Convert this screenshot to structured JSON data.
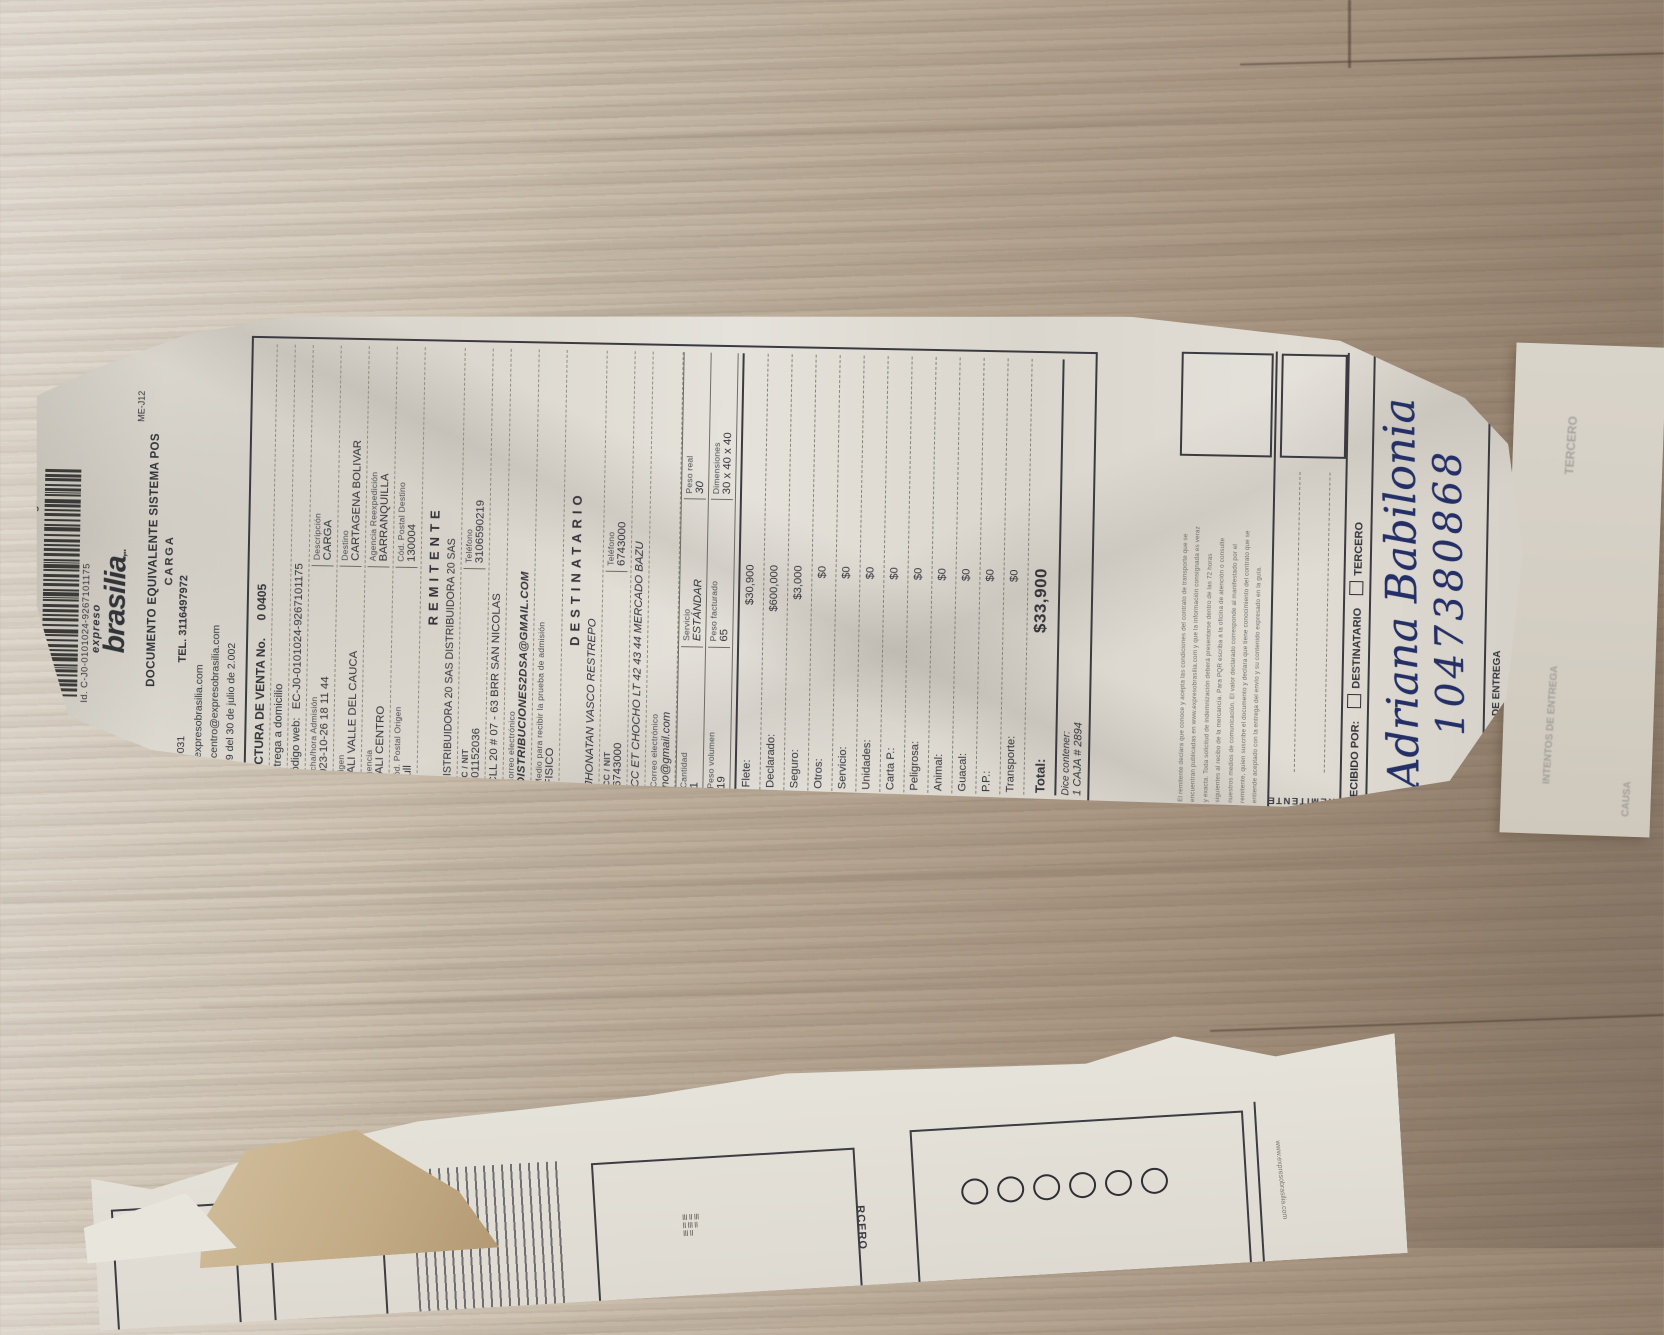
{
  "header": {
    "ce_label": "CE - Contra Entrega",
    "form_code": "ME-J12",
    "id_line": "Id. C-J0-0101024-9267101175",
    "brand_top": "expreso",
    "brand_main": "brasilia",
    "brand_suffix": ",..",
    "doc_title": "DOCUMENTO EQUIVALENTE SISTEMA POS",
    "doc_subtitle": "CARGA",
    "account_number": "90100031",
    "phone": "TEL. 3116497972",
    "web": "www.expresobrasilia.com",
    "email": "enviocentro@expresobrasilia.com",
    "resolution": "00159 del 30 de julio de 2.002"
  },
  "invoice": {
    "factura_label": "FACTURA  DE  VENTA  No.",
    "factura_value": "0  0405",
    "entrega": "Entrega a domicilio",
    "codigo_web_label": "Código web:",
    "codigo_web_value": "EC-J0-0101024-9267101175",
    "fecha_label": "Fecha/hora Admisión",
    "fecha_value": "2023-10-26 18 11 44",
    "descripcion_label": "Descripción",
    "descripcion_value": "CARGA",
    "origen_label": "Origen",
    "origen_value": "CALI VALLE DEL CAUCA",
    "destino_label": "Destino",
    "destino_value": "CARTAGENA BOLIVAR",
    "agencia_label": "Agencia",
    "agencia_value": "CALI CENTRO",
    "reexp_label": "Agencia Reexpedición",
    "reexp_value": "BARRANQUILLA",
    "cp_origen_label": "Cód. Postal Origen",
    "cp_origen_value": "null",
    "cp_destino_label": "Cód. Postal Destino",
    "cp_destino_value": "130004"
  },
  "remitente": {
    "title": "REMITENTE",
    "nombre": "DISTRIBUIDORA 20 SAS DISTRIBUIDORA 20 SAS",
    "cc_label": "CC / NIT",
    "cc_value": "901152036",
    "tel_label": "Teléfono",
    "tel_value": "3106590219",
    "direccion": "CLL 20 # 07 - 63 BRR SAN NICOLAS",
    "correo_label": "Correo electrónico",
    "correo_value": "DISTRIBUCIONES2DSA@GMAIL.COM",
    "medio_label": "Medio para recibir la prueba de admisión",
    "medio_value": "FISICO"
  },
  "destinatario": {
    "title": "DESTINATARIO",
    "nombre": "JHONATAN VASCO RESTREPO",
    "cc_label": "CC / NIT",
    "cc_value": "6743000",
    "tel_label": "Teléfono",
    "tel_value": "6743000",
    "direccion": "CC ET CHOCHO LT 42 43 44 MERCADO BAZU",
    "correo_label": "Correo electrónico",
    "correo_value": "no@gmail.com"
  },
  "shipment": {
    "cantidad_label": "Cantidad",
    "cantidad_value": "1",
    "servicio_label": "Servicio",
    "servicio_value": "ESTÁNDAR",
    "peso_real_label": "Peso real",
    "peso_real_value": "30",
    "peso_vol_label": "Peso volumen",
    "peso_vol_value": "19",
    "peso_fact_label": "Peso facturado",
    "peso_fact_value": "65",
    "dim_label": "Dimensiones",
    "dim_value": "30 x 40 x 40"
  },
  "charges": [
    {
      "label": "Flete:",
      "value": "$30,900"
    },
    {
      "label": "Declarado:",
      "value": "$600,000"
    },
    {
      "label": "Seguro:",
      "value": "$3,000"
    },
    {
      "label": "Otros:",
      "value": "$0"
    },
    {
      "label": "Servicio:",
      "value": "$0"
    },
    {
      "label": "Unidades:",
      "value": "$0"
    },
    {
      "label": "Carta P.:",
      "value": "$0"
    },
    {
      "label": "Peligrosa:",
      "value": "$0"
    },
    {
      "label": "Animal:",
      "value": "$0"
    },
    {
      "label": "Guacal:",
      "value": "$0"
    },
    {
      "label": "P.P.:",
      "value": "$0"
    },
    {
      "label": "Transporte:",
      "value": "$0"
    }
  ],
  "total": {
    "label": "Total:",
    "value": "$33,900"
  },
  "contenido": {
    "label": "Dice contener:",
    "value": "1 CAJA # 2894"
  },
  "fine_print_lines": [
    "El remitente declara que conoce y acepta las condiciones del contrato de transporte que se",
    "encuentran publicadas en www.expresobrasilia.com y que la información consignada es veraz",
    "y exacta. Toda solicitud de indemnización deberá presentarse dentro de las 72 horas",
    "siguientes al recibo de la mercancía. Para PQR escriba a la oficina de atención o consulte",
    "nuestros medios de comunicación. El valor declarado corresponde al manifestado por el",
    "remitente, quien suscribe el documento y declara que tiene conocimiento del contrato que se",
    "entiende aceptado con la entrega del envío y su contenido expresado en la guía."
  ],
  "signature": {
    "recibido_label": "RECIBIDO POR:",
    "opcion_destinatario": "DESTINATARIO",
    "opcion_tercero": "TERCERO",
    "remitente_label": "REMITENTE",
    "destinatario_label": "DESTINATARIO",
    "fecha_label": "FECHA Y HORA DE ENTREGA",
    "handwriting_name": "Adriana Babilonia",
    "handwriting_id": "1047380868"
  },
  "under_slip": {
    "ghost_tercero": "TERCERO",
    "ghost_intentos": "INTENTOS DE ENTREGA",
    "ghost_causa": "CAUSA"
  },
  "fragment2": {
    "tercero_fragment": "RCERO",
    "web_fragment": "www.expresobrasilia.com",
    "circle_count": 6
  }
}
